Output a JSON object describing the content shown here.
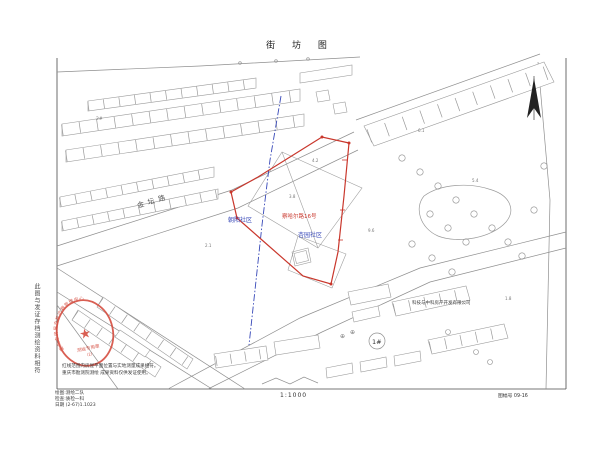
{
  "title": "街 坊 图",
  "map": {
    "road_label": "金坛路",
    "parcel_label_red": "察哈尔路16号",
    "community_left": "朝阳社区",
    "community_right": "杏园社区",
    "building_no_label": "1#",
    "company_label": "科技与中科房产开发有限公司",
    "spots": [
      "2#",
      "2.1",
      "4.2",
      "3.8",
      "6.1",
      "5.4",
      "9.6",
      "1.8"
    ],
    "symbol_circle_cross": "⊕"
  },
  "stamp": {
    "arc_text": "重庆市房屋产权产籍管理中心",
    "star": "★",
    "line1": "测绘专用章",
    "line2": "(2)"
  },
  "side_note_vertical": "此图与发证存档测绘资料相符",
  "notes": {
    "line1": "红线范围内房屋平面位置与实地测量成果相符。",
    "line2": "重庆市勘测院测绘 成果资料仅供发证使用。"
  },
  "margin": {
    "info1": "绘图:测绘二队",
    "info2": "检查:质检一科",
    "info3": "日期 (2-67)1.1023",
    "scale": "1:1000",
    "sheet_no": "图幅号 09-16"
  },
  "colors": {
    "boundary_red": "#c9372c",
    "cadastral_blue": "#3748b8",
    "stamp_red": "#d4493c",
    "ink": "#444444",
    "linework_gray": "#8a8a8a"
  }
}
